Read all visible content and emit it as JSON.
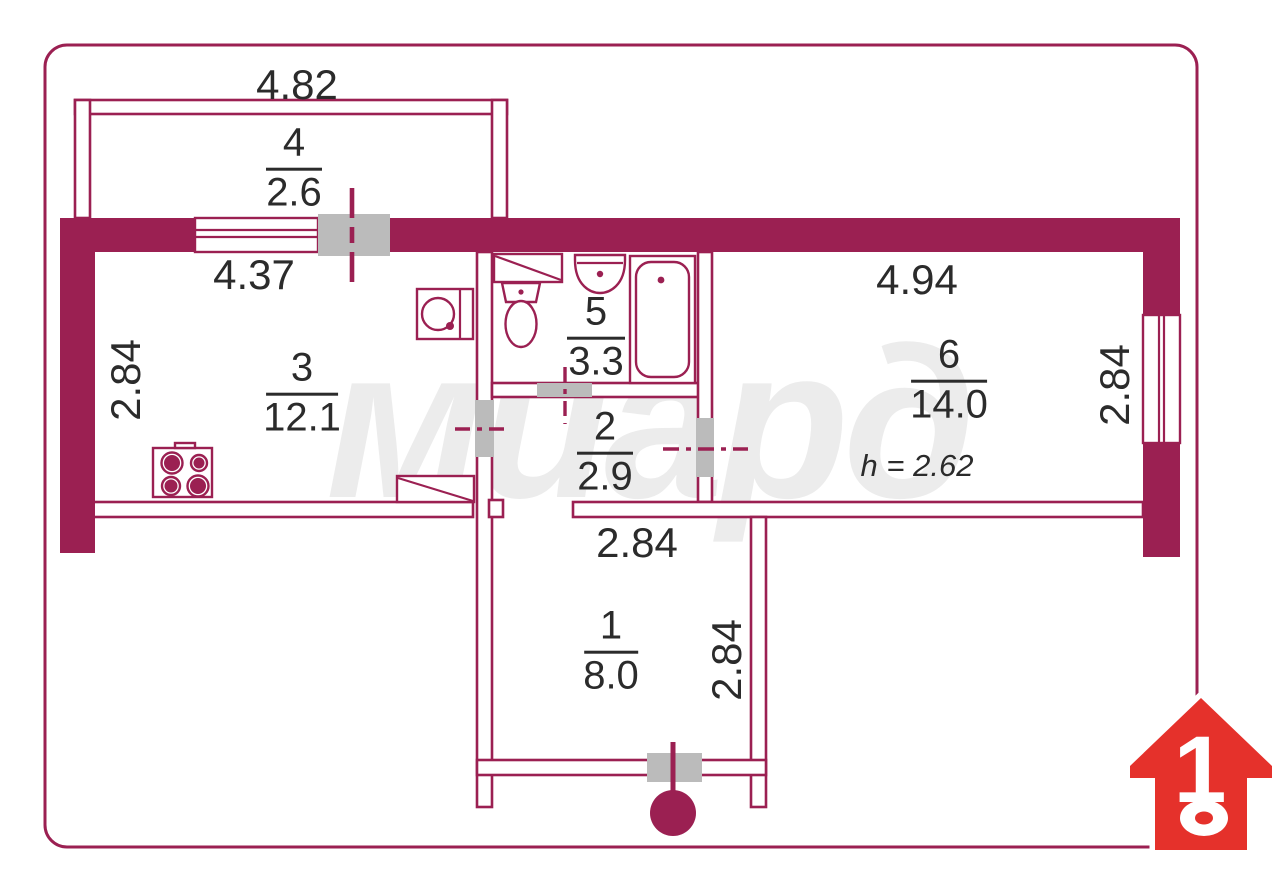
{
  "title": "apartment floor plan",
  "colors": {
    "wall": "#9B2052",
    "gray": "#BBBBBB",
    "text": "#2B2B2B",
    "wm": "#ECECEC",
    "logo": "#E5312B"
  },
  "watermark": "миард",
  "logo": {
    "number": "1"
  },
  "rooms": [
    {
      "number": "1",
      "area": "8.0"
    },
    {
      "number": "2",
      "area": "2.9"
    },
    {
      "number": "3",
      "area": "12.1"
    },
    {
      "number": "4",
      "area": "2.6"
    },
    {
      "number": "5",
      "area": "3.3"
    },
    {
      "number": "6",
      "area": "14.0"
    }
  ],
  "dimensions": {
    "balcony_width": "4.82",
    "kitchen_width": "4.37",
    "kitchen_depth": "2.84",
    "room6_width": "4.94",
    "room6_depth": "2.84",
    "hall_width": "2.84",
    "room1_depth": "2.84",
    "ceiling_height": "h = 2.62"
  }
}
